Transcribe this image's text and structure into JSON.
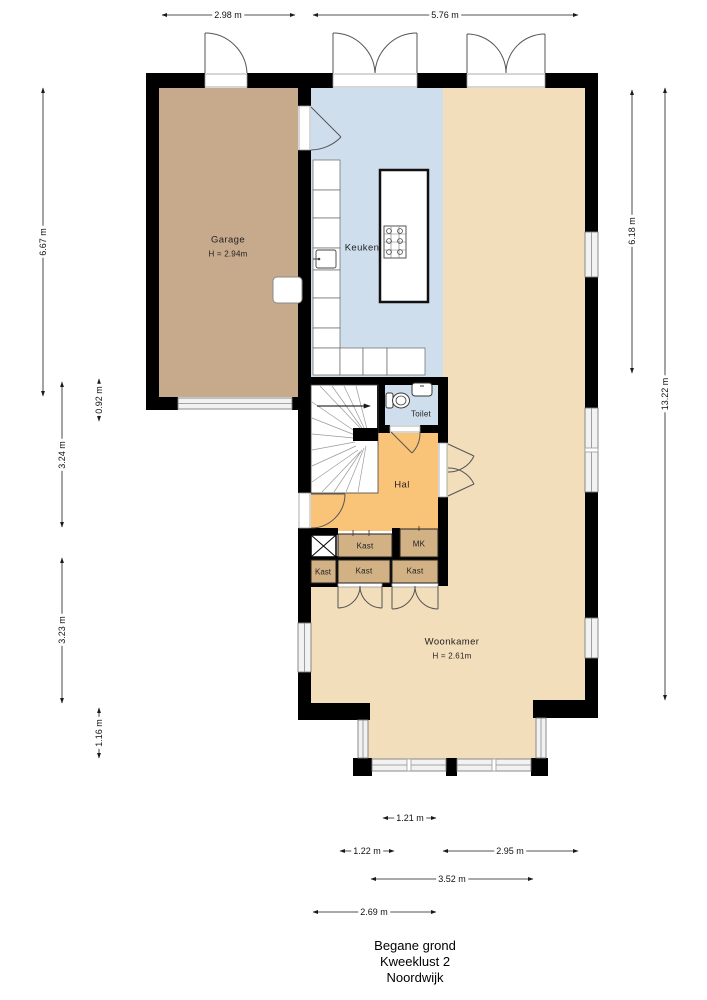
{
  "title": {
    "line1": "Begane grond",
    "line2": "Kweeklust 2",
    "line3": "Noordwijk"
  },
  "rooms": {
    "garage": {
      "name": "Garage",
      "ceiling": "H = 2.94m"
    },
    "keuken": {
      "name": "Keuken"
    },
    "toilet": {
      "name": "Toilet"
    },
    "hal": {
      "name": "Hal"
    },
    "woonkamer": {
      "name": "Woonkamer",
      "ceiling": "H = 2.61m"
    },
    "closets": {
      "kast_top": "Kast",
      "mk": "MK",
      "kast_small": "Kast",
      "kast_mid": "Kast",
      "kast_right": "Kast"
    }
  },
  "dimensions": {
    "top": [
      {
        "label": "2.98 m"
      },
      {
        "label": "5.76 m"
      }
    ],
    "left": [
      {
        "label": "6.67 m"
      },
      {
        "label": "0.92 m"
      },
      {
        "label": "3.24 m"
      },
      {
        "label": "3.23 m"
      },
      {
        "label": "1.16 m"
      }
    ],
    "right": [
      {
        "label": "6.18 m"
      },
      {
        "label": "13.22 m"
      }
    ],
    "bottom": [
      {
        "label": "1.21 m"
      },
      {
        "label": "1.22 m"
      },
      {
        "label": "2.95 m"
      },
      {
        "label": "3.52 m"
      },
      {
        "label": "2.69 m"
      }
    ]
  },
  "colors": {
    "wall": "#000000",
    "garage": "#c7a98b",
    "keuken": "#cfdeec",
    "woonkamer": "#f3debb",
    "hal": "#fac478",
    "closet": "#d2b285",
    "door_line": "#555555"
  }
}
